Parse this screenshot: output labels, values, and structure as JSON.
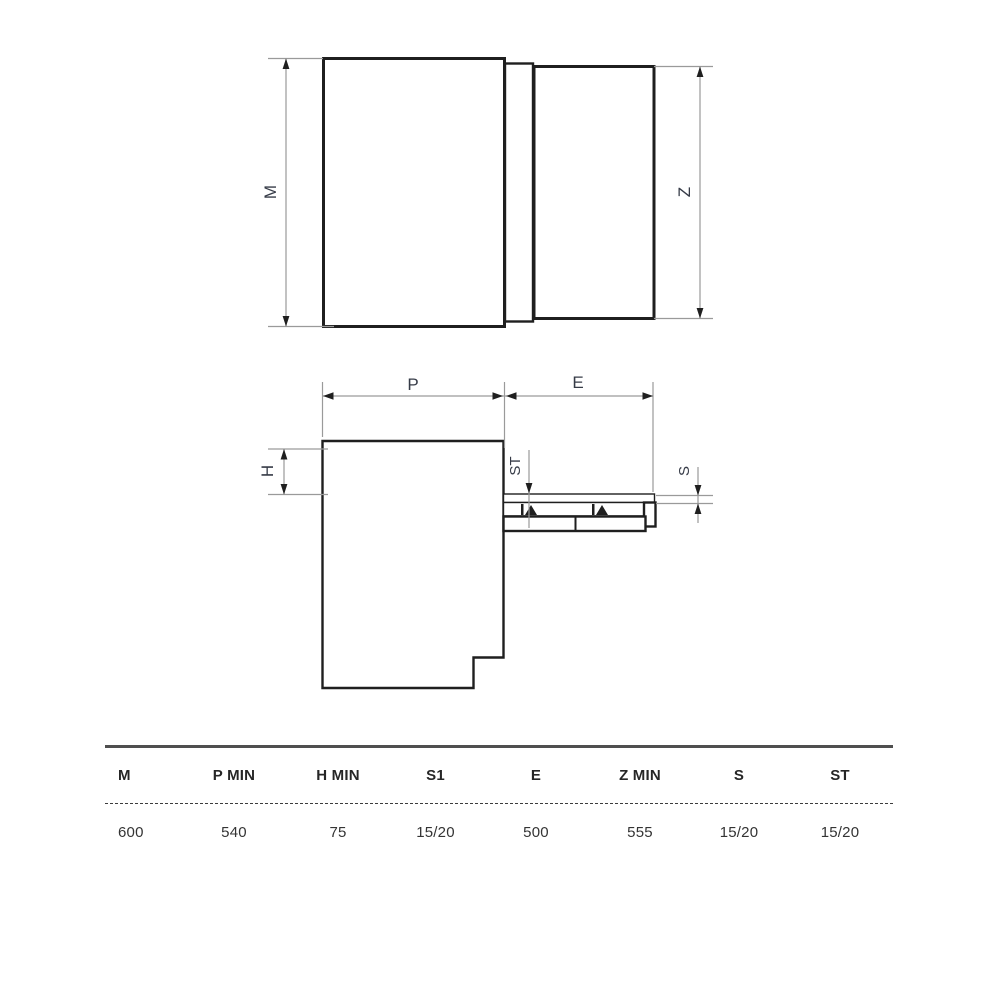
{
  "diagram": {
    "labels": {
      "m": "M",
      "z": "Z",
      "p": "P",
      "e": "E",
      "h": "H",
      "st": "ST",
      "s": "S"
    },
    "colors": {
      "outline": "#1f1f1f",
      "dimension_line": "#9a9a9a",
      "panel_fill": "#ececec",
      "label_text": "#363b47",
      "table_rule": "#4f4f4f"
    }
  },
  "table": {
    "headers": [
      "M",
      "P MIN",
      "H MIN",
      "S1",
      "E",
      "Z MIN",
      "S",
      "ST"
    ],
    "values": [
      "600",
      "540",
      "75",
      "15/20",
      "500",
      "555",
      "15/20",
      "15/20"
    ]
  }
}
